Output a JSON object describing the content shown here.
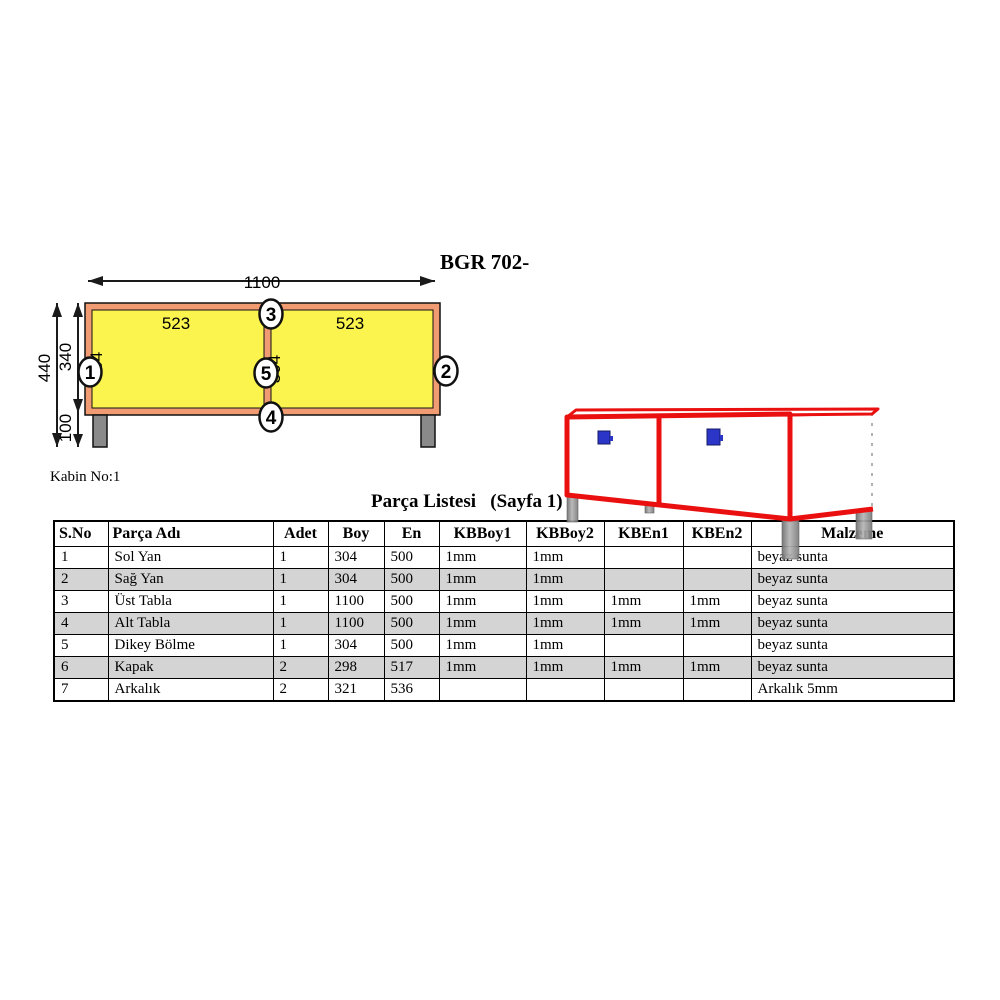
{
  "page": {
    "drawing_title": "BGR 702-",
    "cabin_label": "Kabin No:1",
    "list_title": "Parça Listesi   (Sayfa 1)"
  },
  "front_view": {
    "dims": {
      "width_total": "1100",
      "height_total": "440",
      "height_body": "340",
      "height_leg": "100",
      "panel_width": "523",
      "panel_height": "304"
    },
    "callouts": [
      "1",
      "2",
      "3",
      "4",
      "5"
    ],
    "colors": {
      "frame": "#F09B72",
      "panel": "#FBF44F",
      "leg": "#8A8A8A"
    }
  },
  "iso_view": {
    "colors": {
      "edge": "#EA1010",
      "handle": "#2B35C8",
      "leg": "#909090"
    }
  },
  "table": {
    "headers": [
      "S.No",
      "Parça Adı",
      "Adet",
      "Boy",
      "En",
      "KBBoy1",
      "KBBoy2",
      "KBEn1",
      "KBEn2",
      "Malzeme"
    ],
    "rows": [
      [
        "1",
        "Sol Yan",
        "1",
        "304",
        "500",
        "1mm",
        "1mm",
        "",
        "",
        "beyaz sunta"
      ],
      [
        "2",
        "Sağ Yan",
        "1",
        "304",
        "500",
        "1mm",
        "1mm",
        "",
        "",
        "beyaz sunta"
      ],
      [
        "3",
        "Üst Tabla",
        "1",
        "1100",
        "500",
        "1mm",
        "1mm",
        "1mm",
        "1mm",
        "beyaz sunta"
      ],
      [
        "4",
        "Alt Tabla",
        "1",
        "1100",
        "500",
        "1mm",
        "1mm",
        "1mm",
        "1mm",
        "beyaz sunta"
      ],
      [
        "5",
        "Dikey Bölme",
        "1",
        "304",
        "500",
        "1mm",
        "1mm",
        "",
        "",
        "beyaz sunta"
      ],
      [
        "6",
        "Kapak",
        "2",
        "298",
        "517",
        "1mm",
        "1mm",
        "1mm",
        "1mm",
        "beyaz sunta"
      ],
      [
        "7",
        "Arkalık",
        "2",
        "321",
        "536",
        "",
        "",
        "",
        "",
        "Arkalık 5mm"
      ]
    ],
    "stripe_color": "#D4D4D4"
  }
}
